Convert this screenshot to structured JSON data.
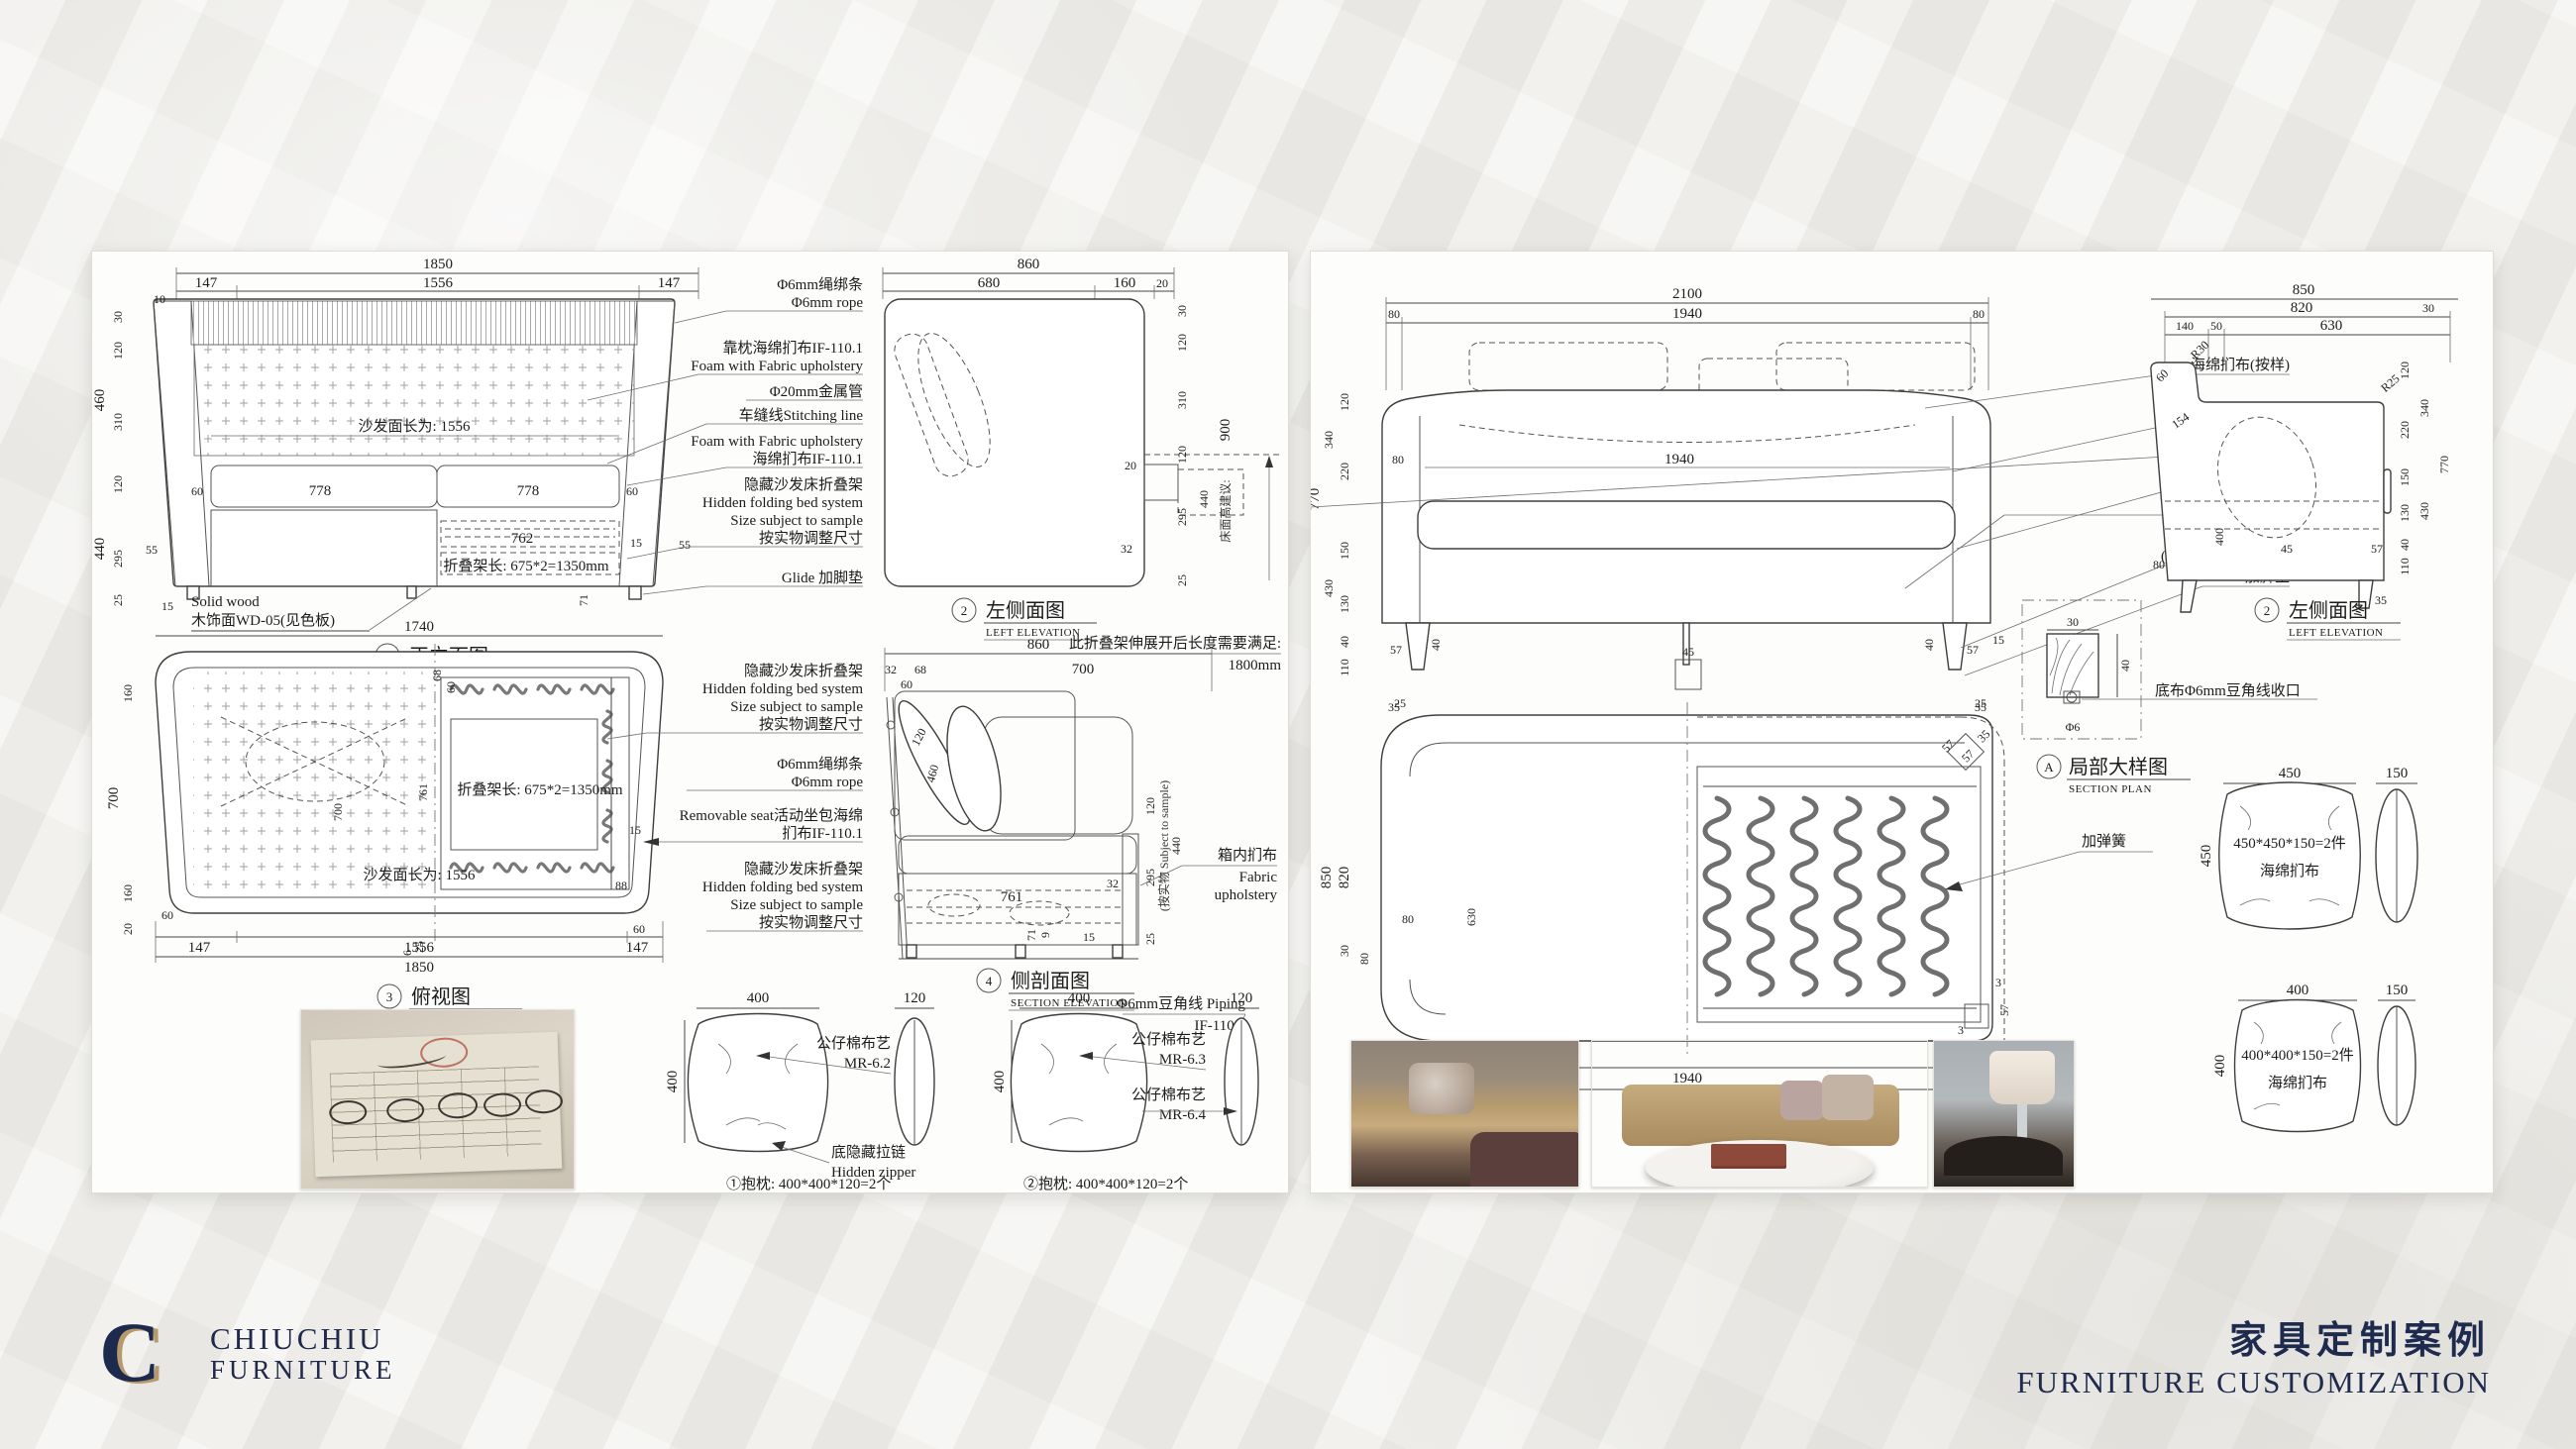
{
  "lp": {
    "front": {
      "top": [
        "1850",
        "147",
        "1556",
        "147",
        "10"
      ],
      "left": [
        "460",
        "440",
        "30",
        "120",
        "310",
        "120",
        "295",
        "25",
        "55",
        "15"
      ],
      "inner": [
        "沙发面长为: 1556",
        "60",
        "778",
        "778",
        "60",
        "762",
        "15",
        "折叠架长: 675*2=1350mm",
        "71",
        "55"
      ],
      "notes": [
        "Solid wood",
        "木饰面WD-05(见色板)"
      ],
      "t": {
        "n": "1",
        "zh": "正立面图",
        "en": "FRONT ELEVATION"
      }
    },
    "ann1": [
      "Φ6mm绳绑条",
      "Φ6mm rope",
      "靠枕海绵扪布IF-110.1",
      "Foam with Fabric upholstery",
      "Φ20mm金属管",
      "车缝线Stitching line",
      "Foam with Fabric upholstery",
      "海绵扪布IF-110.1",
      "隐藏沙发床折叠架",
      "Hidden folding bed system",
      "Size subject to sample",
      "按实物调整尺寸",
      "Glide 加脚垫"
    ],
    "side": {
      "top": [
        "860",
        "680",
        "160",
        "20"
      ],
      "right": [
        "30",
        "120",
        "310",
        "120",
        "295",
        "25",
        "440",
        "900",
        "床面高建议:",
        "20",
        "32"
      ],
      "note": [
        "此折叠架伸展开后长度需要满足:",
        "1800mm"
      ],
      "t": {
        "n": "2",
        "zh": "左侧面图",
        "en": "LEFT ELEVATION"
      }
    },
    "plan": {
      "top": [
        "1740"
      ],
      "left": [
        "160",
        "700",
        "160",
        "20"
      ],
      "inner": [
        "68",
        "60",
        "700",
        "761",
        "折叠架长: 675*2=1350mm",
        "沙发面长为: 1556",
        "88",
        "15",
        "60",
        "25",
        "6",
        "60"
      ],
      "bottom": [
        "147",
        "1556",
        "147",
        "1850"
      ],
      "t": {
        "n": "3",
        "zh": "俯视图",
        "en": "PLAN VIEW"
      }
    },
    "ann2": [
      "隐藏沙发床折叠架",
      "Hidden folding bed system",
      "Size subject to sample",
      "按实物调整尺寸",
      "Φ6mm绳绑条",
      "Φ6mm rope",
      "Removable seat活动坐包海绵",
      "扪布IF-110.1",
      "隐藏沙发床折叠架",
      "Hidden folding bed system",
      "Size subject to sample",
      "按实物调整尺寸"
    ],
    "section": {
      "top": [
        "860",
        "32",
        "68",
        "60",
        "700"
      ],
      "inner": [
        "120",
        "460",
        "761",
        "71",
        "9",
        "15",
        "32"
      ],
      "right": [
        "120",
        "295",
        "440",
        "25",
        "(按实物 Subject to sample)"
      ],
      "lbl": [
        "箱内扪布",
        "Fabric",
        "upholstery"
      ],
      "pip": [
        "Φ6mm豆角线 Piping",
        "IF-110.3"
      ],
      "t": {
        "n": "4",
        "zh": "侧剖面图",
        "en": "SECTION ELEVATION"
      }
    },
    "p1": {
      "w": "400",
      "h": "400",
      "s": "120",
      "a1": "公仔棉布艺",
      "a2": "MR-6.2",
      "z1": "底隐藏拉链",
      "z2": "Hidden zipper",
      "cap": "①抱枕: 400*400*120=2个"
    },
    "p2": {
      "w": "400",
      "h": "400",
      "s": "120",
      "a1": "公仔棉布艺",
      "a2": "MR-6.3",
      "b1": "公仔棉布艺",
      "b2": "MR-6.4",
      "cap": "②抱枕: 400*400*120=2个"
    }
  },
  "rp": {
    "front": {
      "top": [
        "2100",
        "80",
        "1940",
        "80"
      ],
      "left": [
        "770",
        "340",
        "430",
        "120",
        "220",
        "150",
        "130",
        "40",
        "110"
      ],
      "inner": [
        "80",
        "1940",
        "40",
        "45",
        "40",
        "57",
        "57",
        "15"
      ],
      "bottom": [
        "35",
        "35"
      ],
      "t": {
        "n": "1",
        "zh": "正立面图",
        "en": "FRONT ELEVATION"
      }
    },
    "ann": [
      "海绵扪布(按样)",
      "车缝线",
      "Φ6mm豆角线",
      "车缝线",
      "拉方低入2mm",
      "西南桦实木脚",
      "(按胡桃木色)WD-02",
      "加脚垫"
    ],
    "side": {
      "top": [
        "850",
        "820",
        "140",
        "50",
        "630",
        "30"
      ],
      "inner": [
        "R30",
        "60",
        "154",
        "R25",
        "400",
        "45",
        "80"
      ],
      "right": [
        "120",
        "220",
        "150",
        "130",
        "40",
        "110",
        "340",
        "430",
        "770",
        "57",
        "35"
      ],
      "t": {
        "n": "2",
        "zh": "左侧面图",
        "en": "LEFT ELEVATION"
      }
    },
    "plan": {
      "top": [
        "25",
        "25",
        "57",
        "57",
        "35"
      ],
      "left": [
        "850",
        "820",
        "30",
        "80"
      ],
      "inner": [
        "630",
        "80",
        "3",
        "57",
        "3",
        "57"
      ],
      "bottom": [
        "80",
        "1940",
        "80",
        "2100"
      ],
      "spring": "加弹簧",
      "t": {
        "n": "3",
        "zh": "俯视图",
        "en": "PLAN VIEW"
      }
    },
    "detail": {
      "w": "30",
      "h": "40",
      "d": "Φ6",
      "lbl": "底布Φ6mm豆角线收口",
      "t": {
        "n": "A",
        "zh": "局部大样图",
        "en": "SECTION PLAN"
      }
    },
    "pa": {
      "w": "450",
      "hl": "450",
      "s": "150",
      "l1": "450*450*150=2件",
      "l2": "海绵扪布"
    },
    "pb": {
      "w": "400",
      "hl": "400",
      "s": "150",
      "l1": "400*400*150=2件",
      "l2": "海绵扪布"
    }
  },
  "footer": {
    "logo": "C",
    "b1": "CHIUCHIU",
    "b2": "FURNITURE",
    "zh": "家具定制案例",
    "en": "FURNITURE CUSTOMIZATION"
  }
}
